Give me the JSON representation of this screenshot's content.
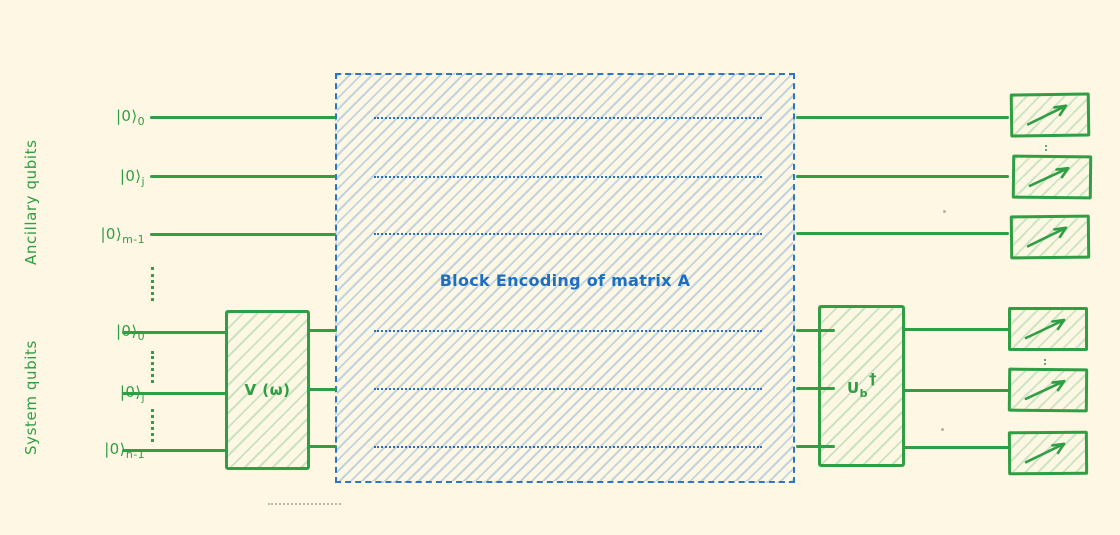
{
  "diagram": {
    "groups": {
      "ancillary_label": "Ancillary qubits",
      "system_label": "System qubits"
    },
    "qubits": {
      "ancillary": [
        {
          "ket": "|0⟩",
          "sub": "0"
        },
        {
          "ket": "|0⟩",
          "sub": "j"
        },
        {
          "ket": "|0⟩",
          "sub": "m-1"
        }
      ],
      "system": [
        {
          "ket": "|0⟩",
          "sub": "0"
        },
        {
          "ket": "|0⟩",
          "sub": "j"
        },
        {
          "ket": "|0⟩",
          "sub": "n-1"
        }
      ]
    },
    "gates": {
      "state_prep": {
        "label": "V (ω)"
      },
      "block_encoding": {
        "label": "Block Encoding of matrix A"
      },
      "unprep": {
        "base": "U",
        "sub": "b",
        "sup": "†"
      }
    },
    "colors": {
      "background": "#fdf7e3",
      "green_stroke": "#2f9e44",
      "blue_stroke": "#2b76c9",
      "blue_text": "#1d6fc2"
    }
  }
}
